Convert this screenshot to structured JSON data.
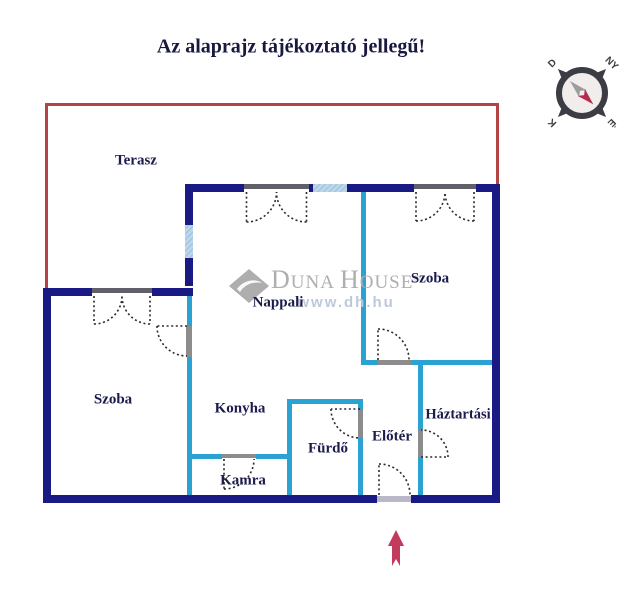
{
  "title": "Az alaprajz tájékoztató jellegű!",
  "rooms": {
    "terasz": "Terasz",
    "nappali": "Nappali",
    "szoba_jobb": "Szoba",
    "szoba_bal": "Szoba",
    "konyha": "Konyha",
    "kamra": "Kamra",
    "furdo": "Fürdő",
    "eloter": "Előtér",
    "haztartasi": "Háztartási"
  },
  "watermark": {
    "brand_initial_1": "D",
    "brand_rest_1": "UNA",
    "brand_initial_2": "H",
    "brand_rest_2": "OUSE",
    "registered_mark": "®",
    "url": "www.dh.hu"
  },
  "compass": {
    "ne": "NY",
    "se": "É",
    "sw": "K",
    "nw": "D"
  },
  "colors": {
    "wall_navy": "#1a1a85",
    "wall_cyan": "#2ba2d2",
    "terrace_red": "#b24444",
    "window_blue": "#bcd6ea",
    "window_stripe": "#8fb8d8",
    "label_navy": "#1b1b4d",
    "title_navy": "#181840",
    "lintel_gray": "#60606a",
    "leaf_gray": "#8c8c8c",
    "threshold_gray": "#b8b8c8",
    "arrow_crimson": "#c23a5c",
    "watermark_gray": "#aeaeae",
    "watermark_url_blue": "#bdc9d9",
    "compass_dark": "#3c3c44",
    "compass_face": "#f1eded",
    "compass_gray_needle": "#9c9c9c",
    "compass_red_needle": "#b52d4c"
  }
}
